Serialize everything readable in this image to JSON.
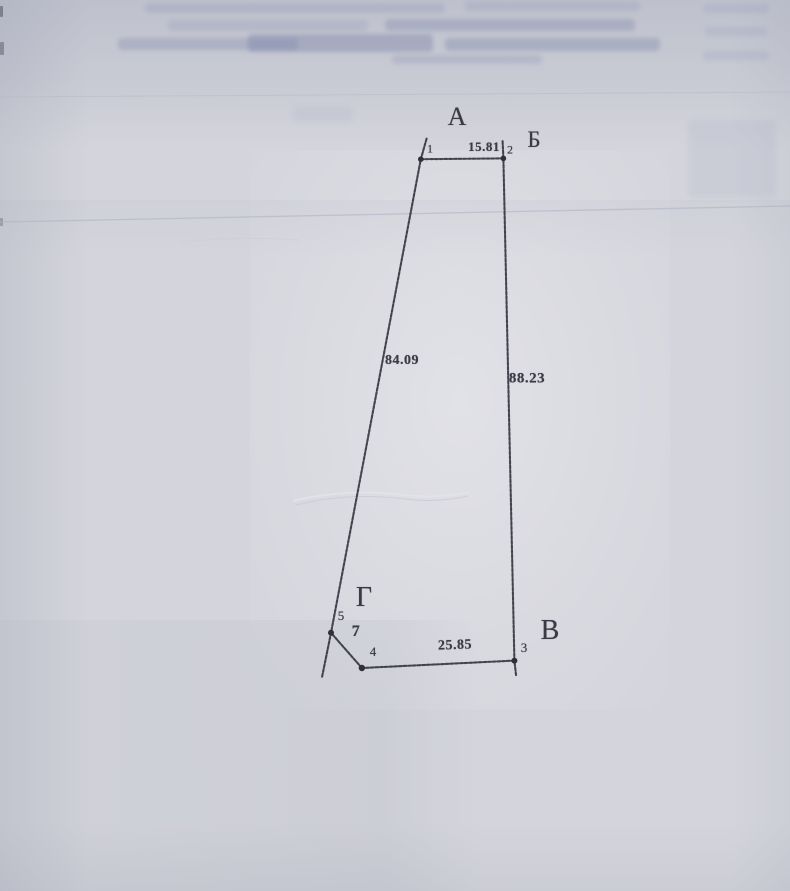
{
  "palette": {
    "paper": "#d4d5dc",
    "ink": "#3a3b46",
    "boundary_line": "#383943",
    "faint_rule": "#b5b9c6"
  },
  "plan": {
    "corners": [
      {
        "label": "А",
        "position": "top, near point 1"
      },
      {
        "label": "Б",
        "position": "top-right, near point 2"
      },
      {
        "label": "В",
        "position": "bottom-right, near point 3"
      },
      {
        "label": "Г",
        "position": "bottom-left, near point 5"
      }
    ],
    "points": [
      {
        "number": "1"
      },
      {
        "number": "2"
      },
      {
        "number": "3"
      },
      {
        "number": "4"
      },
      {
        "number": "5"
      }
    ],
    "sides": [
      {
        "from": "1",
        "to": "2",
        "length": "15.81"
      },
      {
        "from": "2",
        "to": "3",
        "length": "88.23"
      },
      {
        "from": "3",
        "to": "4",
        "length": "25.85"
      },
      {
        "from": "4",
        "to": "5",
        "length": "7"
      },
      {
        "from": "5",
        "to": "1",
        "length": "84.09"
      }
    ]
  }
}
